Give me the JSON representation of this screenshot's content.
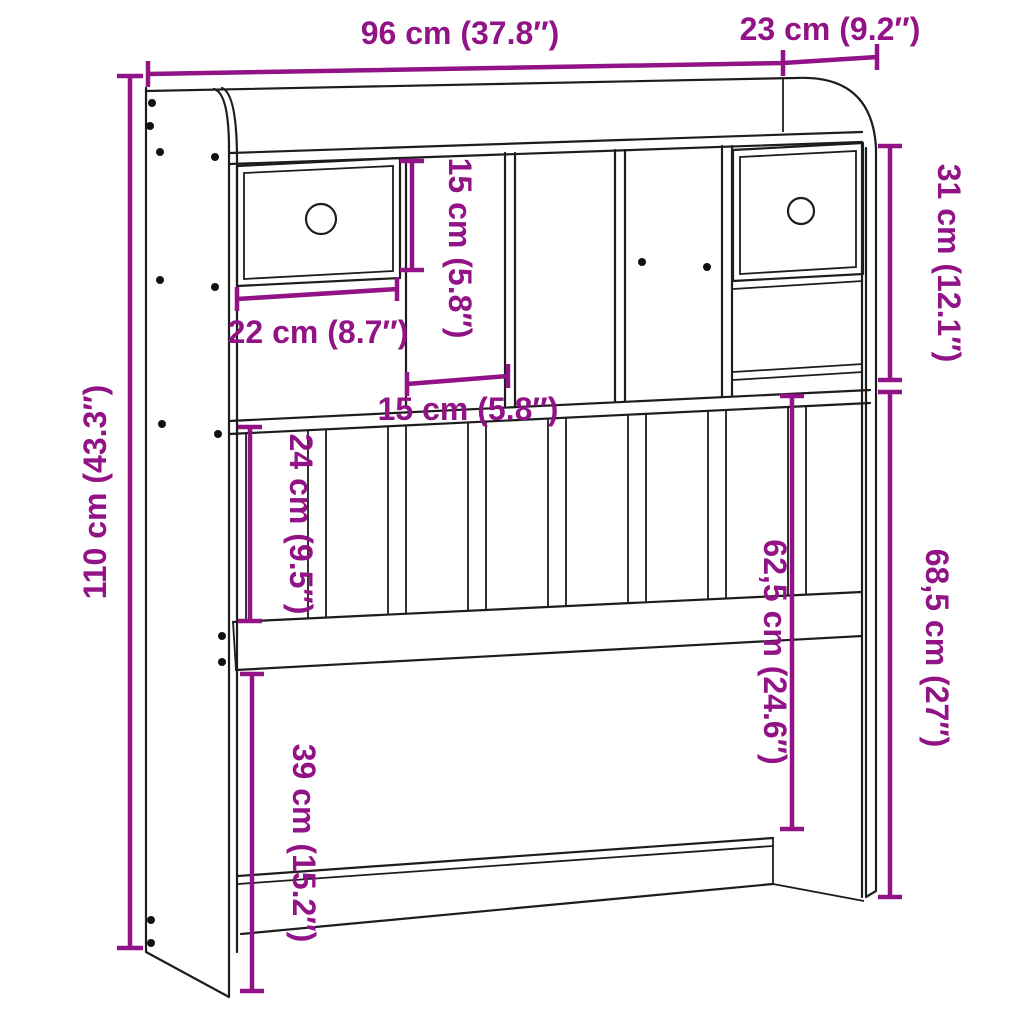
{
  "diagram": {
    "type": "furniture-dimension-diagram",
    "subject": "headboard-with-storage",
    "accent_color": "#911386",
    "line_color": "#1d1d1d",
    "background_color": "#ffffff",
    "dimensions": {
      "overall_width": "96 cm (37.8″)",
      "side_depth": "23 cm (9.2″)",
      "overall_height": "110 cm (43.3″)",
      "cubby_height": "15 cm (5.8″)",
      "top_section_height": "31 cm (12.1″)",
      "drawer_width": "22 cm (8.7″)",
      "cubby_width": "15 cm (5.8″)",
      "slat_section_height": "24 cm (9.5″)",
      "shelf_to_rail_height": "62,5 cm (24.6″)",
      "right_section_height": "68,5 cm (27″)",
      "lower_gap_height": "39 cm (15.2″)"
    }
  }
}
